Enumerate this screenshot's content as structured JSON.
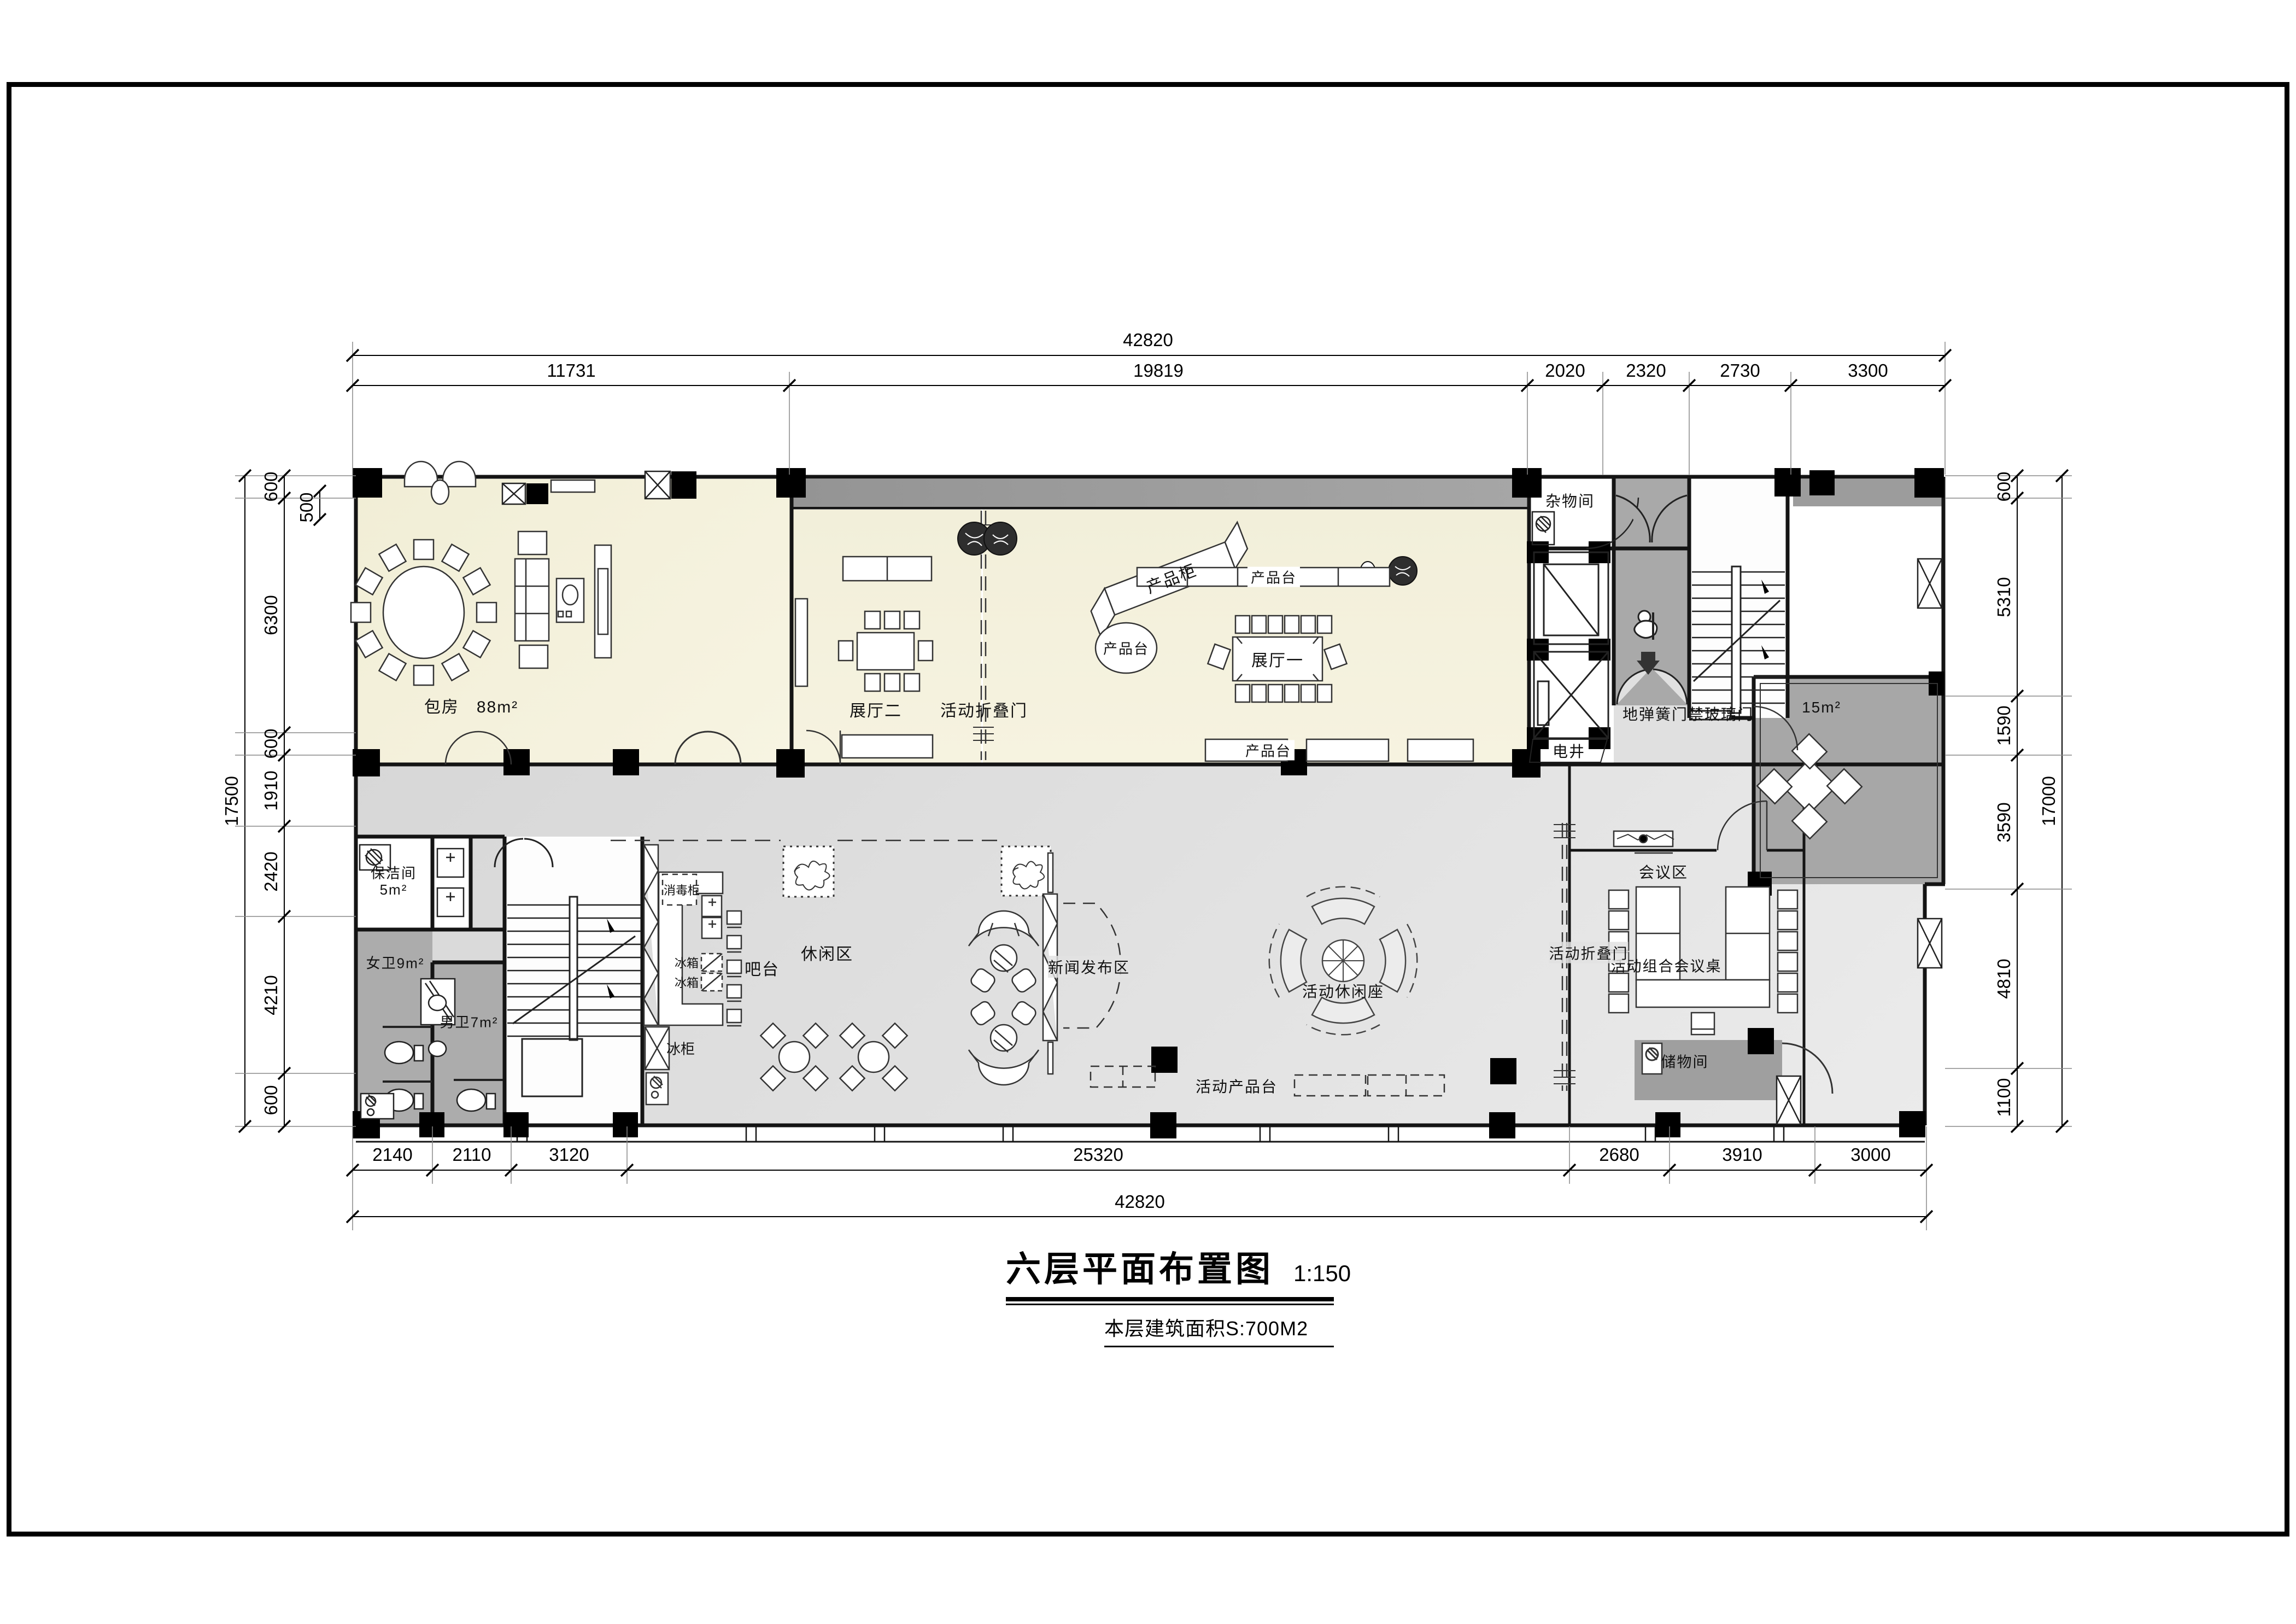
{
  "title": {
    "name": "六层平面布置图",
    "scale": "1:150",
    "area_note": "本层建筑面积S:700M2"
  },
  "dims": {
    "top_total": "42820",
    "top_segments": [
      "11731",
      "19819",
      "2020",
      "2320",
      "2730",
      "3300"
    ],
    "bottom_segments": [
      "2140",
      "2110",
      "3120",
      "25320",
      "2680",
      "3910",
      "3000"
    ],
    "bottom_total": "42820",
    "left_total": "17500",
    "left_segments": [
      "600",
      "500",
      "6300",
      "600",
      "1910",
      "2420",
      "4210",
      "600"
    ],
    "right_total": "17000",
    "right_segments": [
      "600",
      "5310",
      "1590",
      "3590",
      "4810",
      "1100"
    ]
  },
  "rooms": {
    "baofang": "包房",
    "baofang_area": "88m²",
    "zhanting2": "展厅二",
    "zhanting1": "展厅一",
    "zawujian": "杂物间",
    "dianjing": "电井",
    "baojiejian": "保洁间",
    "baojie_area": "5m²",
    "nvwei": "女卫9m²",
    "nanwei": "男卫7m²",
    "room15": "15m²",
    "huiyiqu": "会议区",
    "chuwujian": "储物间",
    "xiuxianqu": "休闲区",
    "xinwenfabuqu": "新闻发布区",
    "batai": "吧台"
  },
  "features": {
    "chanpingui": "产品柜",
    "chanpintai": "产品台",
    "huodong_zhediemen": "活动折叠门",
    "dihuangmen": "地弹簧门禁玻璃门",
    "xiaodugui": "消毒柜",
    "bingxiang": "冰箱",
    "binggui": "冰柜",
    "huodong_xiuxianzuo": "活动休闲座",
    "huodong_chanpintai": "活动产品台",
    "huiyi_table": "活动组合会议桌"
  },
  "colors": {
    "room_cream": "#f4f1dc",
    "corridor_dark": "#9c9c9c",
    "hall_light": "#e2e2e2",
    "wc_gray": "#ababab",
    "line": "#1a1a1a"
  }
}
